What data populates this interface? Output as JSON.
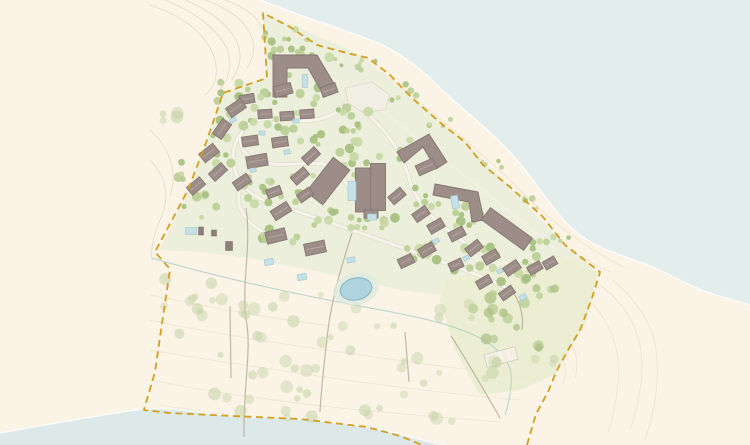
{
  "map": {
    "description": "coastal-resort-master-plan",
    "width": 750,
    "height": 445,
    "palette": {
      "land": "#faf3e6",
      "water_top": "#e2edec",
      "water_bottom": "#dde8e8",
      "shoreline": "#ffffff",
      "resort_green": "#ecefdb",
      "park_green": "#e7ecce",
      "boundary_gold": "#d2a01e",
      "building_fill": "#9c8d89",
      "building_stroke": "#84746f",
      "building_ridge": "#b5a7a2",
      "shed_fill": "#8d7f7a",
      "road_fill": "#f7f4ec",
      "road_casing": "#d6cfc0",
      "shore_road": "#f3efe4",
      "dune_path": "#bfae98",
      "stream": "#a9cdc6",
      "pond_fill": "#aed4e0",
      "pond_stroke": "#85b2c2",
      "pond_halo": "#dfeade",
      "pool_fill": "#c6e0e8",
      "pool_stroke": "#9fc3cf",
      "contour_nw": "#ddd5c6",
      "contour_dune": "#e8dfca",
      "contour_beach": "#e6dcc8",
      "beach_hatch": "#ecdfc2",
      "court_fill": "#f4efe2",
      "court_stroke": "#d8d0bd",
      "plaza_fill": "#f1eee4",
      "plaza_stroke": "#ddd6c6",
      "tree_resort": [
        "#bccf97",
        "#a8c182",
        "#c8d8a6"
      ],
      "tree_dune": [
        "#c9d6ac",
        "#bfcf9e"
      ],
      "tree_park": [
        "#b7cb92",
        "#a9c084"
      ]
    },
    "water": {
      "top": "M260,0 C290,12 320,22 335,27 C360,37 375,40 392,50 C412,62 424,72 437,85 C458,106 480,122 500,142 C525,166 543,196 562,218 C585,245 612,252 640,262 C665,271 690,287 710,293 C725,298 740,302 750,305 L750,0 Z",
      "top_edge": "M260,0 C290,12 320,22 335,27 C360,37 375,40 392,50 C412,62 424,72 437,85 C458,106 480,122 500,142 C525,166 543,196 562,218 C585,245 612,252 640,262 C665,271 690,287 710,293 C725,298 740,302 750,305",
      "bottom": "M0,433 C50,424 100,415 143,409 C175,407 200,413 233,416 C260,418 280,417 300,419 C325,421 345,423 367,427 C390,431 410,437 430,442 L445,445 L0,445 Z",
      "bottom_edge": "M0,433 C50,424 100,415 143,409 C175,407 200,413 233,416 C260,418 280,417 300,419 C325,421 345,423 367,427 C390,431 410,437 430,442 L445,445"
    },
    "greens": [
      {
        "kind": "resort",
        "d": "M263,13 L267,78 L223,93 L207,140 L188,190 L160,250 L200,252 L250,258 L300,268 L350,278 L400,290 L440,295 L445,280 L500,263 L560,255 L600,272 L565,245 L510,187 L465,142 L412,98 L360,55 L300,28 Z"
      },
      {
        "kind": "park",
        "d": "M445,280 L500,265 L560,255 L598,272 L585,325 L555,375 L520,390 L480,395 L455,350 L440,300 Z"
      }
    ],
    "boundary": {
      "d": "M527,445 L536,414 L548,392 L557,370 L568,350 L580,330 L592,298 L600,272 L565,245 L543,217 L510,187 L483,165 L465,142 L443,125 L412,98 L390,75 L368,58 L347,53 L317,45 L290,27 L263,13 L267,78 L223,93 L207,140 L188,190 L155,252 L170,269 L167,290 L160,337 L155,372 L144,410 L170,413 L233,416 L300,419 L367,427 L400,436 L422,445",
      "dash": "7 4.5",
      "width": 1.8
    },
    "contours": {
      "nw": [
        "M150,5 C180,15 200,30 210,48 C220,66 218,85 205,95",
        "M165,0 C195,12 215,28 225,45 C233,60 230,78 220,90",
        "M185,0 C210,10 228,25 236,40 C243,54 240,68 232,80",
        "M205,0 C228,8 243,20 250,33 C256,45 254,58 247,68",
        "M225,0 C245,7 257,17 262,28",
        "M150,130 C170,148 178,172 170,196",
        "M150,160 C165,175 170,195 162,215 C156,230 150,245 152,260"
      ],
      "dune": [
        "M150,320 C220,335 290,345 360,355 C430,365 490,372 540,380",
        "M150,350 C220,362 290,372 360,382 C420,390 470,396 520,400",
        "M150,380 C210,392 270,400 340,408 C400,414 450,418 500,422",
        "M160,405 C220,415 280,421 340,427",
        "M150,295 C210,308 270,318 330,326"
      ],
      "beach": [
        "M600,285 C620,300 635,320 640,345 C645,370 640,400 630,430",
        "M612,280 C635,298 652,322 656,350 C660,380 655,410 645,440",
        "M590,300 C605,318 615,335 618,360 C620,385 615,410 608,432",
        "M560,330 C575,345 580,360 575,378",
        "M555,348 C565,358 568,370 563,384"
      ],
      "hatch": [
        "M280,28 C330,48 370,60 405,90 C440,120 480,150 520,190 C550,220 580,245 625,268",
        "M272,38 C320,58 360,72 395,100 C430,130 468,160 505,196 C535,226 565,250 610,272"
      ]
    },
    "stream": "M152,258 C220,278 300,295 370,308 C420,317 455,325 480,338 C495,346 505,356 510,368 C513,380 510,400 505,415",
    "roads": [
      "M353,92 C343,114 322,123 296,120 C272,117 249,117 242,132 C236,147 247,159 265,163 C287,167 308,161 324,164",
      "M242,132 C229,149 231,169 242,184 C254,199 274,206 296,211",
      "M296,211 C332,223 372,237 412,251 C447,263 482,276 512,290",
      "M353,92 C362,108 373,119 384,131 C396,145 403,159 408,175",
      "M408,175 C413,194 423,209 437,221 C451,233 464,243 478,252",
      "M324,164 C338,172 346,180 350,190",
      "M242,184 C236,196 238,208 246,218 C252,226 262,232 274,236"
    ],
    "shore_road": "M273,48 C310,65 350,85 390,117 C430,149 470,180 510,212 C530,228 545,240 556,250",
    "dune_paths": [
      "M246,208 C252,248 240,288 247,325 C251,355 243,390 244,437",
      "M352,233 C341,268 331,300 327,338 C324,365 321,392 320,412",
      "M230,306 L231,378",
      "M405,332 L409,382",
      "M451,336 C468,362 484,390 500,418",
      "M512,290 C520,302 524,316 522,330"
    ],
    "plaza": "M345,88 L372,82 L390,95 L385,110 L362,112 L348,103 Z",
    "buildings_large_paths": [
      "M273,55 L317,55 L336,87 L324,96 L308,68 L287,68 L287,97 L273,97 Z",
      "M397,152 L429,134 L447,162 L436,169 L423,147 L404,163 Z",
      "M435,184 L478,192 L484,220 L472,222 L469,202 L433,195 Z"
    ],
    "buildings_large_rects": [
      [
        328,
        181,
        44,
        21,
        -52
      ],
      [
        364,
        190,
        17,
        44,
        0
      ],
      [
        378,
        187,
        15,
        47,
        0
      ],
      [
        371,
        214,
        14,
        8,
        0
      ],
      [
        507,
        229,
        52,
        15,
        36
      ]
    ],
    "villas": [
      [
        283,
        90,
        18,
        11,
        -15
      ],
      [
        329,
        90,
        16,
        10,
        -20
      ],
      [
        247,
        99,
        15,
        9,
        -10
      ],
      [
        236,
        108,
        18,
        11,
        -35
      ],
      [
        265,
        114,
        14,
        9,
        -4
      ],
      [
        287,
        116,
        14,
        9,
        -4
      ],
      [
        307,
        114,
        14,
        9,
        -4
      ],
      [
        222,
        129,
        18,
        11,
        -55
      ],
      [
        250,
        141,
        16,
        10,
        -8
      ],
      [
        280,
        142,
        16,
        10,
        -8
      ],
      [
        209,
        153,
        18,
        11,
        -38
      ],
      [
        257,
        161,
        21,
        12,
        -10
      ],
      [
        311,
        156,
        17,
        10,
        -42
      ],
      [
        196,
        186,
        17,
        10,
        -40
      ],
      [
        218,
        172,
        17,
        10,
        -42
      ],
      [
        242,
        182,
        17,
        10,
        -35
      ],
      [
        300,
        176,
        17,
        10,
        -40
      ],
      [
        274,
        192,
        15,
        9,
        -20
      ],
      [
        281,
        211,
        19,
        11,
        -32
      ],
      [
        305,
        195,
        15,
        9,
        -35
      ],
      [
        276,
        236,
        20,
        12,
        -14
      ],
      [
        315,
        248,
        21,
        12,
        -12
      ],
      [
        426,
        167,
        19,
        11,
        -24
      ],
      [
        397,
        196,
        16,
        10,
        -40
      ],
      [
        421,
        214,
        16,
        10,
        -35
      ],
      [
        436,
        226,
        16,
        10,
        -30
      ],
      [
        457,
        234,
        16,
        10,
        -27
      ],
      [
        474,
        248,
        16,
        10,
        -38
      ],
      [
        427,
        250,
        16,
        10,
        -30
      ],
      [
        406,
        261,
        15,
        10,
        -25
      ],
      [
        491,
        257,
        16,
        10,
        -30
      ],
      [
        512,
        268,
        16,
        10,
        -34
      ],
      [
        535,
        268,
        14,
        9,
        -30
      ],
      [
        550,
        263,
        13,
        9,
        -30
      ],
      [
        484,
        282,
        15,
        9,
        -30
      ],
      [
        507,
        293,
        15,
        9,
        -35
      ],
      [
        456,
        265,
        14,
        9,
        -25
      ]
    ],
    "sheds": [
      [
        229,
        246,
        7,
        9,
        0
      ],
      [
        201,
        231,
        5,
        8,
        0
      ],
      [
        214,
        233,
        5,
        6,
        0
      ]
    ],
    "pools": [
      [
        305,
        81,
        5,
        13,
        0
      ],
      [
        352,
        191,
        8,
        19,
        0
      ],
      [
        372,
        217,
        9,
        6,
        0
      ],
      [
        455,
        202,
        7,
        13,
        -10
      ],
      [
        191,
        231,
        11,
        7,
        0
      ],
      [
        233,
        120,
        6,
        4,
        -35
      ],
      [
        296,
        121,
        6,
        4,
        0
      ],
      [
        262,
        133,
        6,
        4,
        0
      ],
      [
        253,
        170,
        6,
        4,
        -10
      ],
      [
        287,
        152,
        6,
        4,
        -10
      ],
      [
        269,
        262,
        9,
        6,
        -10
      ],
      [
        302,
        277,
        9,
        6,
        -10
      ],
      [
        351,
        260,
        8,
        5,
        -10
      ],
      [
        436,
        241,
        6,
        4,
        -30
      ],
      [
        466,
        258,
        6,
        4,
        -30
      ],
      [
        500,
        271,
        6,
        4,
        -30
      ],
      [
        523,
        297,
        7,
        5,
        -30
      ]
    ],
    "pond": {
      "cx": 356,
      "cy": 289,
      "rx": 16,
      "ry": 11,
      "rot": -12,
      "halo_rx": 23,
      "halo_ry": 16
    },
    "court": [
      501,
      357,
      32,
      13,
      -15
    ],
    "tree_clusters": [
      [
        300,
        60,
        38,
        16,
        12,
        "resort"
      ],
      [
        253,
        108,
        42,
        22,
        14,
        "resort"
      ],
      [
        215,
        148,
        22,
        22,
        9,
        "resort"
      ],
      [
        290,
        130,
        36,
        18,
        11,
        "resort"
      ],
      [
        338,
        140,
        22,
        14,
        7,
        "resort"
      ],
      [
        255,
        190,
        32,
        18,
        11,
        "resort"
      ],
      [
        300,
        187,
        28,
        16,
        9,
        "resort"
      ],
      [
        352,
        166,
        18,
        22,
        7,
        "resort"
      ],
      [
        395,
        152,
        22,
        16,
        7,
        "resort"
      ],
      [
        330,
        220,
        36,
        14,
        9,
        "resort"
      ],
      [
        380,
        222,
        26,
        13,
        8,
        "resort"
      ],
      [
        428,
        196,
        22,
        18,
        7,
        "resort"
      ],
      [
        460,
        220,
        26,
        16,
        8,
        "resort"
      ],
      [
        422,
        250,
        30,
        13,
        9,
        "resort"
      ],
      [
        480,
        262,
        30,
        16,
        9,
        "resort"
      ],
      [
        518,
        272,
        26,
        16,
        8,
        "resort"
      ],
      [
        543,
        250,
        18,
        11,
        5,
        "resort"
      ],
      [
        282,
        234,
        26,
        11,
        7,
        "resort"
      ],
      [
        202,
        206,
        18,
        13,
        6,
        "resort"
      ],
      [
        187,
        170,
        13,
        11,
        4,
        "resort"
      ],
      [
        232,
        90,
        22,
        9,
        5,
        "resort"
      ],
      [
        311,
        95,
        17,
        9,
        4,
        "resort"
      ],
      [
        363,
        120,
        14,
        10,
        4,
        "resort"
      ],
      [
        345,
        105,
        12,
        8,
        3,
        "resort"
      ],
      [
        272,
        40,
        10,
        18,
        5,
        "resort"
      ],
      [
        352,
        62,
        26,
        9,
        7,
        "shore"
      ],
      [
        400,
        92,
        18,
        9,
        5,
        "shore"
      ],
      [
        444,
        122,
        16,
        8,
        4,
        "shore"
      ],
      [
        488,
        164,
        16,
        8,
        4,
        "shore"
      ],
      [
        528,
        204,
        13,
        7,
        4,
        "shore"
      ],
      [
        558,
        236,
        11,
        7,
        3,
        "shore"
      ],
      [
        296,
        36,
        18,
        7,
        4,
        "shore"
      ],
      [
        516,
        330,
        36,
        28,
        9,
        "park"
      ],
      [
        490,
        302,
        22,
        13,
        5,
        "park"
      ],
      [
        545,
        296,
        16,
        11,
        4,
        "park"
      ],
      [
        200,
        282,
        36,
        22,
        7,
        "dune"
      ],
      [
        278,
        300,
        45,
        26,
        8,
        "dune"
      ],
      [
        358,
        330,
        45,
        26,
        7,
        "dune"
      ],
      [
        252,
        352,
        36,
        26,
        6,
        "dune"
      ],
      [
        182,
        322,
        26,
        22,
        5,
        "dune"
      ],
      [
        320,
        382,
        36,
        22,
        6,
        "dune"
      ],
      [
        418,
        362,
        28,
        22,
        5,
        "dune"
      ],
      [
        452,
        312,
        22,
        18,
        4,
        "dune"
      ],
      [
        478,
        372,
        22,
        18,
        4,
        "dune"
      ],
      [
        225,
        400,
        26,
        16,
        4,
        "dune"
      ],
      [
        302,
        412,
        30,
        16,
        4,
        "dune"
      ],
      [
        382,
        402,
        26,
        16,
        4,
        "dune"
      ],
      [
        548,
        352,
        16,
        12,
        3,
        "dune"
      ],
      [
        430,
        420,
        22,
        12,
        3,
        "dune"
      ],
      [
        175,
        115,
        20,
        16,
        4,
        "dune"
      ]
    ],
    "seed": 7
  }
}
